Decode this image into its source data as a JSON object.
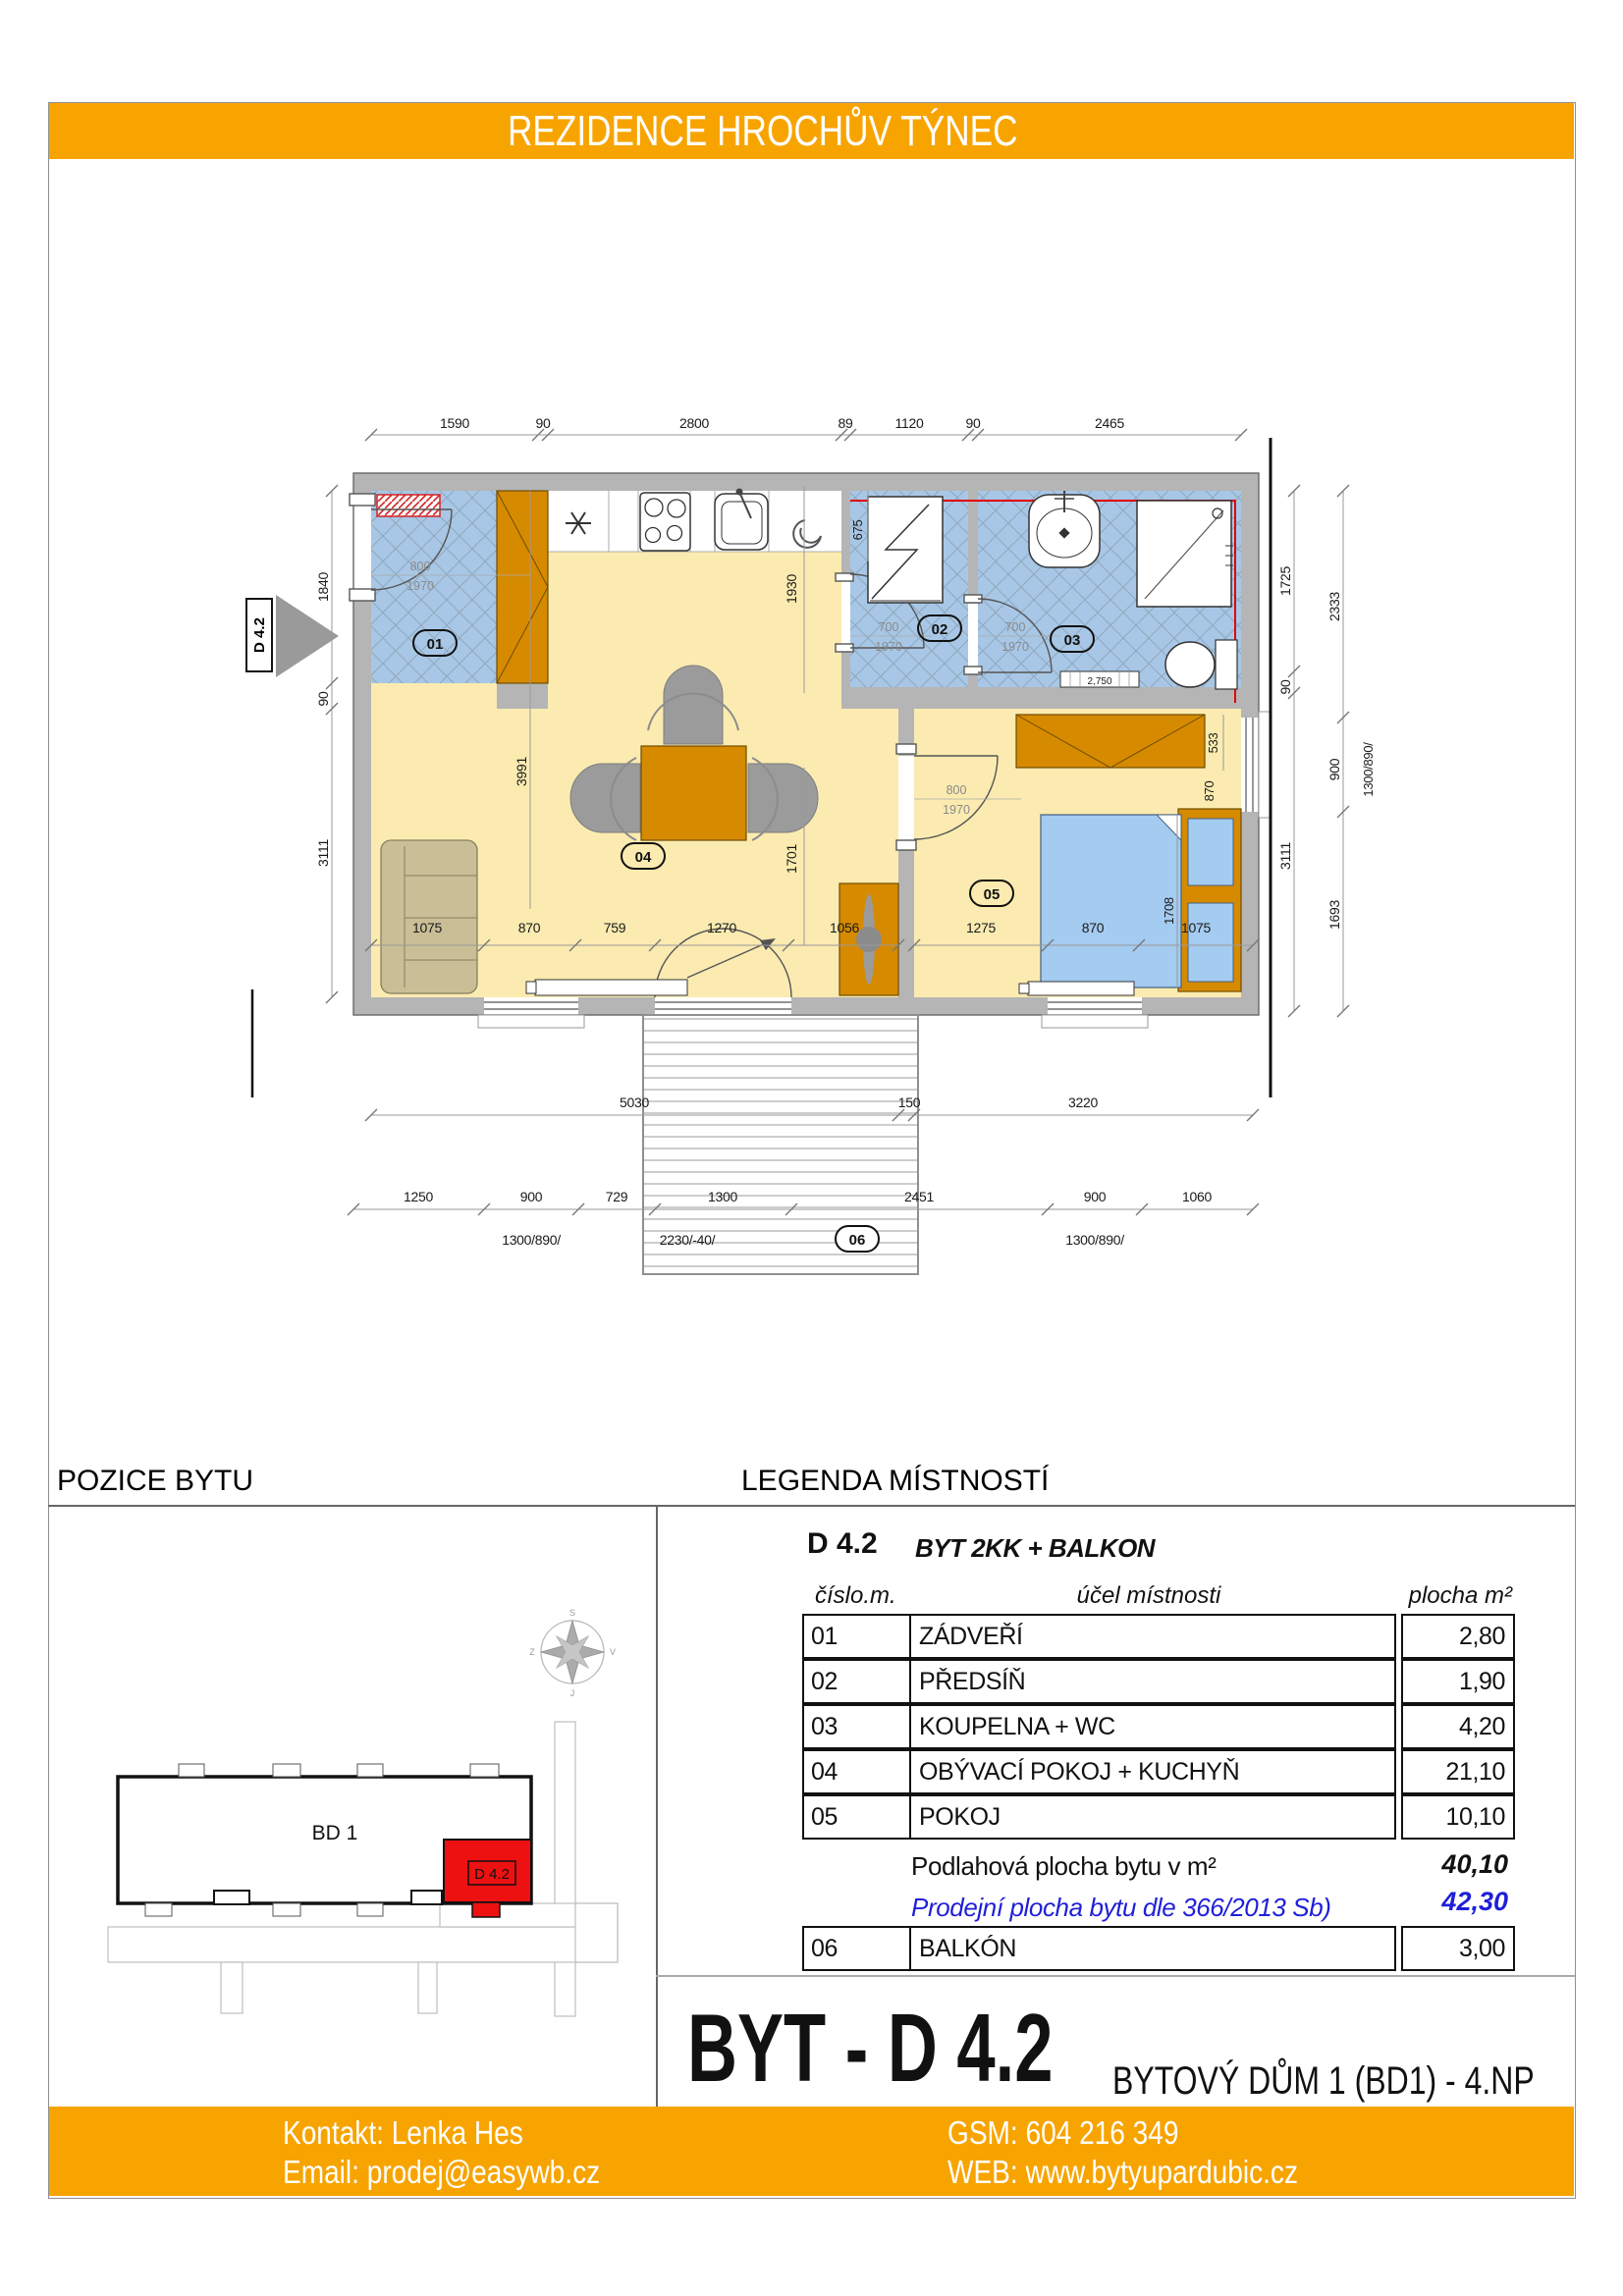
{
  "header": {
    "title": "REZIDENCE HROCHŮV TÝNEC"
  },
  "colors": {
    "brand_orange": "#F7A401",
    "wall_grey": "#B5B5B5",
    "tile_blue": "#A8C7E6",
    "floor_yellow": "#FBEBB0",
    "furniture_orange": "#D68A00",
    "bed_blue": "#A4CBF0",
    "sofa_tan": "#C9BE95",
    "highlight_red": "#EE1111",
    "sale_blue": "#1F1FD9"
  },
  "plan": {
    "section_marker": "D 4.2",
    "dims_top": [
      "1590",
      "90",
      "2800",
      "89",
      "1120",
      "90",
      "2465"
    ],
    "dims_left": [
      "1840",
      "90",
      "3111"
    ],
    "dims_right_inner": [
      "1725",
      "90",
      "3111"
    ],
    "dims_right_outer": [
      "2333",
      "900",
      "1693"
    ],
    "right_window_label": "1300/890/",
    "dims_bottom_row1": [
      "5030",
      "150",
      "3220"
    ],
    "dims_bottom_row2": [
      "1250",
      "900",
      "729",
      "1300",
      "2451",
      "900",
      "1060"
    ],
    "bottom_labels": [
      "1300/890/",
      "2230/-40/",
      "1300/890/"
    ],
    "dims_interior_04": [
      "1075",
      "870",
      "759",
      "1270",
      "1056"
    ],
    "dims_interior_05": [
      "1275",
      "870",
      "1075"
    ],
    "dim_sofa": "3991",
    "dim_balcony_door": "1701",
    "dim_kitchen": "1930",
    "dim_washer": "675",
    "dim_wardrobe05": "533",
    "dim_bed_head": "870",
    "dim_bed_len": "1708",
    "radiator_label": "2,750",
    "doors": {
      "entry": [
        "800",
        "1970"
      ],
      "d02": [
        "700",
        "1970"
      ],
      "d03": [
        "700",
        "1970"
      ],
      "d05": [
        "800",
        "1970"
      ]
    },
    "badges": {
      "b01": "01",
      "b02": "02",
      "b03": "03",
      "b04": "04",
      "b05": "05",
      "b06": "06"
    }
  },
  "pozice": {
    "title": "POZICE BYTU",
    "building_label": "BD 1",
    "unit_label": "D 4.2",
    "compass": {
      "n": "S",
      "e": "V",
      "s": "J",
      "w": "Z"
    }
  },
  "legend": {
    "title": "LEGENDA MÍSTNOSTÍ",
    "code": "D 4.2",
    "type": "BYT 2KK + BALKON",
    "col_headers": [
      "číslo.m.",
      "účel místnosti",
      "plocha m²"
    ],
    "rows": [
      {
        "num": "01",
        "name": "ZÁDVEŘÍ",
        "area": "2,80"
      },
      {
        "num": "02",
        "name": "PŘEDSÍŇ",
        "area": "1,90"
      },
      {
        "num": "03",
        "name": "KOUPELNA + WC",
        "area": "4,20"
      },
      {
        "num": "04",
        "name": "OBÝVACÍ POKOJ + KUCHYŇ",
        "area": "21,10"
      },
      {
        "num": "05",
        "name": "POKOJ",
        "area": "10,10"
      }
    ],
    "summary": [
      {
        "label": "Podlahová plocha bytu v m²",
        "value": "40,10"
      },
      {
        "label": "Prodejní plocha bytu dle 366/2013 Sb)",
        "value": "42,30"
      }
    ],
    "balcony_row": {
      "num": "06",
      "name": "BALKÓN",
      "area": "3,00"
    }
  },
  "title_block": {
    "title": "BYT - D 4.2",
    "subtitle": "BYTOVÝ DŮM 1 (BD1)  -  4.NP"
  },
  "footer": {
    "contact": "Kontakt: Lenka Hes",
    "email": "Email: prodej@easywb.cz",
    "gsm": "GSM: 604 216 349",
    "web": "WEB: www.bytyupardubic.cz"
  }
}
